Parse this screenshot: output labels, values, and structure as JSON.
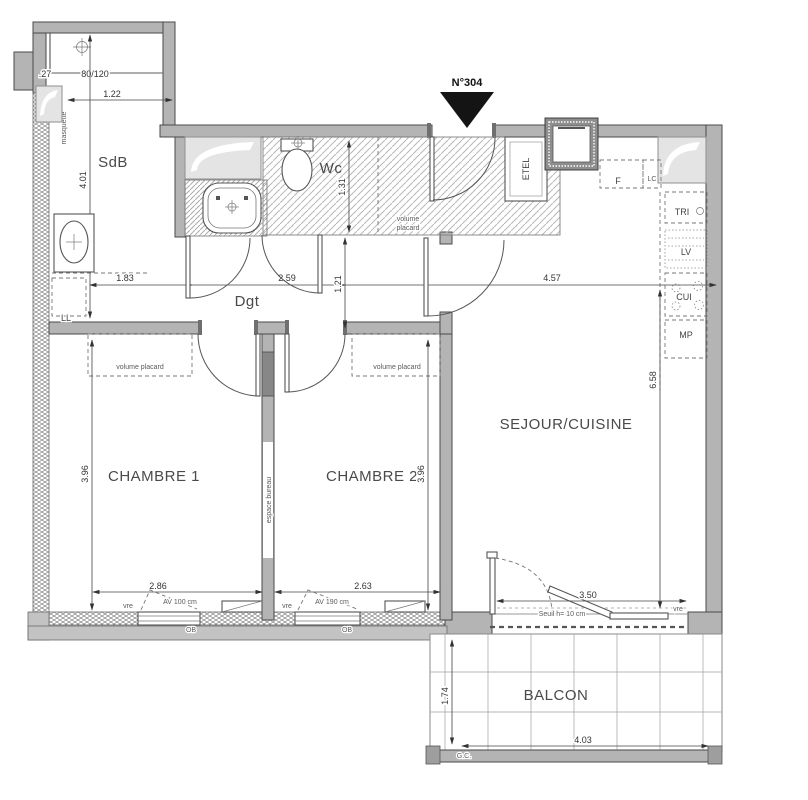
{
  "title": "N°304",
  "rooms": {
    "sdb": "SdB",
    "wc": "Wc",
    "dgt": "Dgt",
    "chambre1": "CHAMBRE 1",
    "chambre2": "CHAMBRE 2",
    "sejour": "SEJOUR/CUISINE",
    "balcon": "BALCON"
  },
  "dimensions": {
    "annex": {
      "wall": ".27",
      "window": "80/120",
      "width": "1.22"
    },
    "sdb_depth": "4.01",
    "wc_depth": "1.31",
    "corridor": {
      "d1": "1.83",
      "d2": "2.59",
      "d3": "1.21",
      "d4": "4.57"
    },
    "kitchen_depth": "6.58",
    "chambre1": {
      "width": "2.86",
      "depth": "3.96"
    },
    "chambre2": {
      "width": "2.63",
      "depth": "3.96"
    },
    "bay": "3.50",
    "balcon": {
      "depth": "1.74",
      "width": "4.03"
    }
  },
  "annotations": {
    "masquette": "masquette",
    "ll": "LL",
    "etel": "ETEL",
    "volume": "volume",
    "placard": "placard",
    "volume_placard": "volume placard",
    "espace_bureau": "espace bureau",
    "f": "F",
    "lc": "LC",
    "tri": "TRI",
    "lv": "LV",
    "cui": "CUI",
    "mp": "MP",
    "vre": "vre",
    "ob": "OB",
    "av1": "AV 100 cm",
    "av2": "AV 190 cm",
    "seuil": "Seuil h= 10 cm",
    "gc": "G.C."
  }
}
